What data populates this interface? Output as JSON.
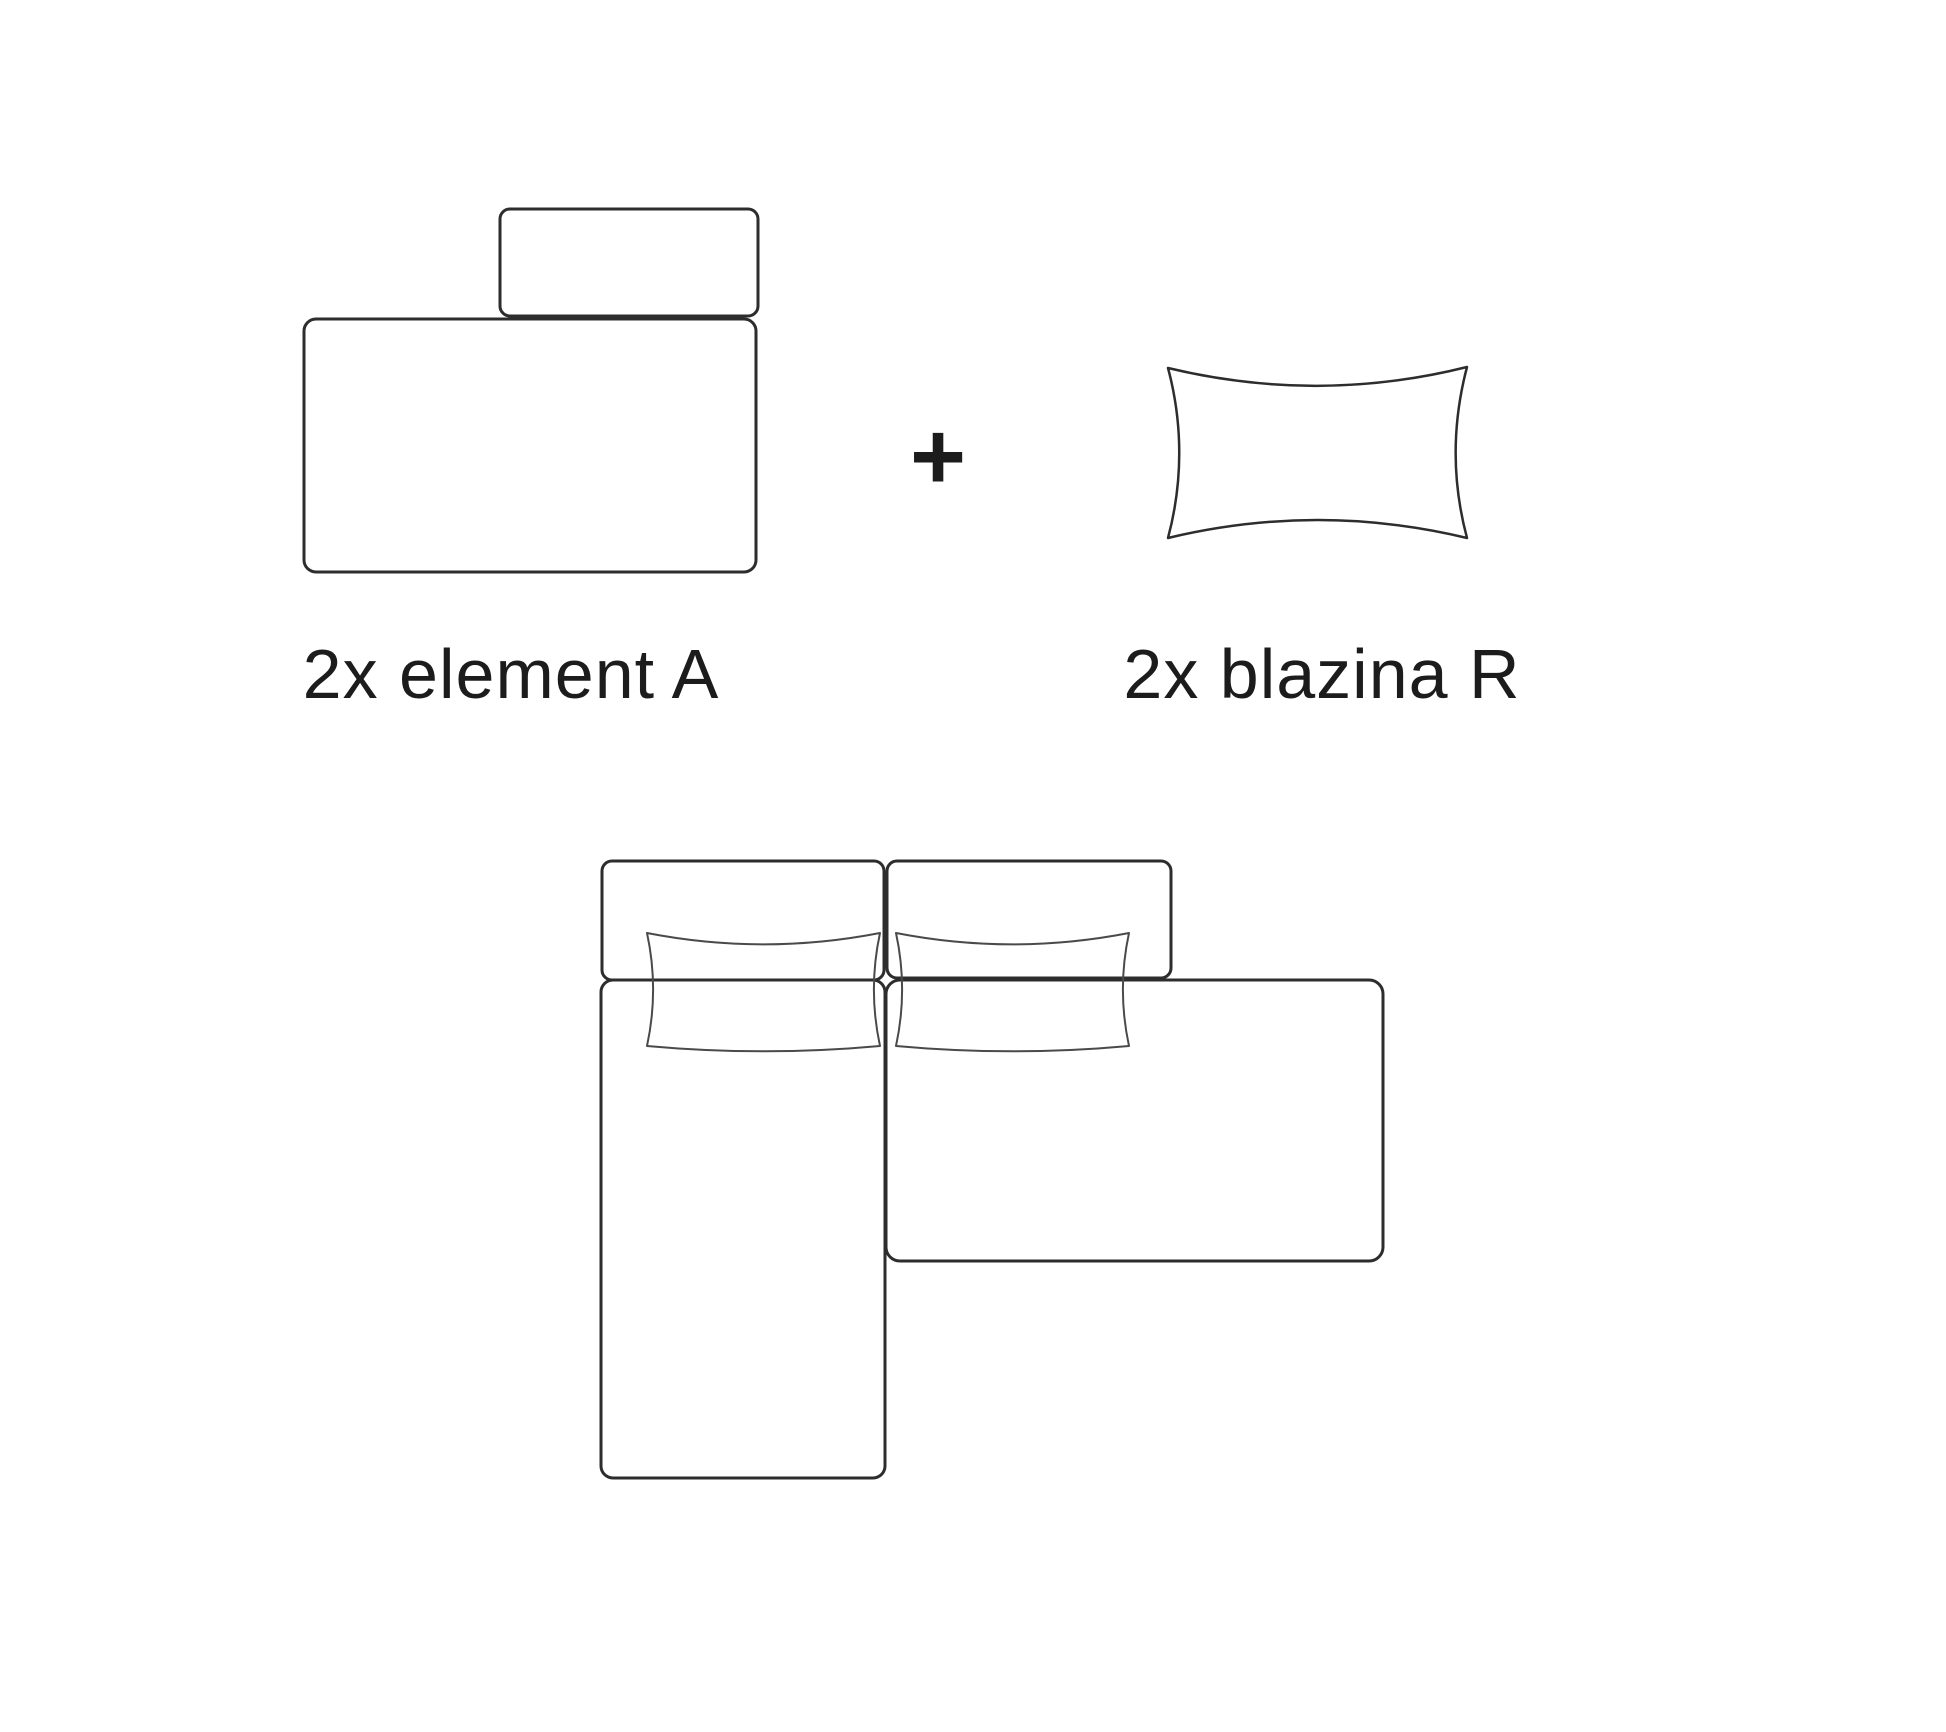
{
  "colors": {
    "background": "#ffffff",
    "furniture_outline": "#2d2d2d",
    "pillow_outline": "#4a4a4a",
    "text": "#1c1c1c"
  },
  "parts_row": {
    "element_a_label": "2x element A",
    "plus_sign": "+",
    "blazina_r_label": "2x blazina R"
  },
  "figures": {
    "element_a": "sofa-element-top-view-icon",
    "blazina_r": "cushion-outline-icon",
    "assembly": "corner-sofa-assembly-top-view-icon"
  }
}
